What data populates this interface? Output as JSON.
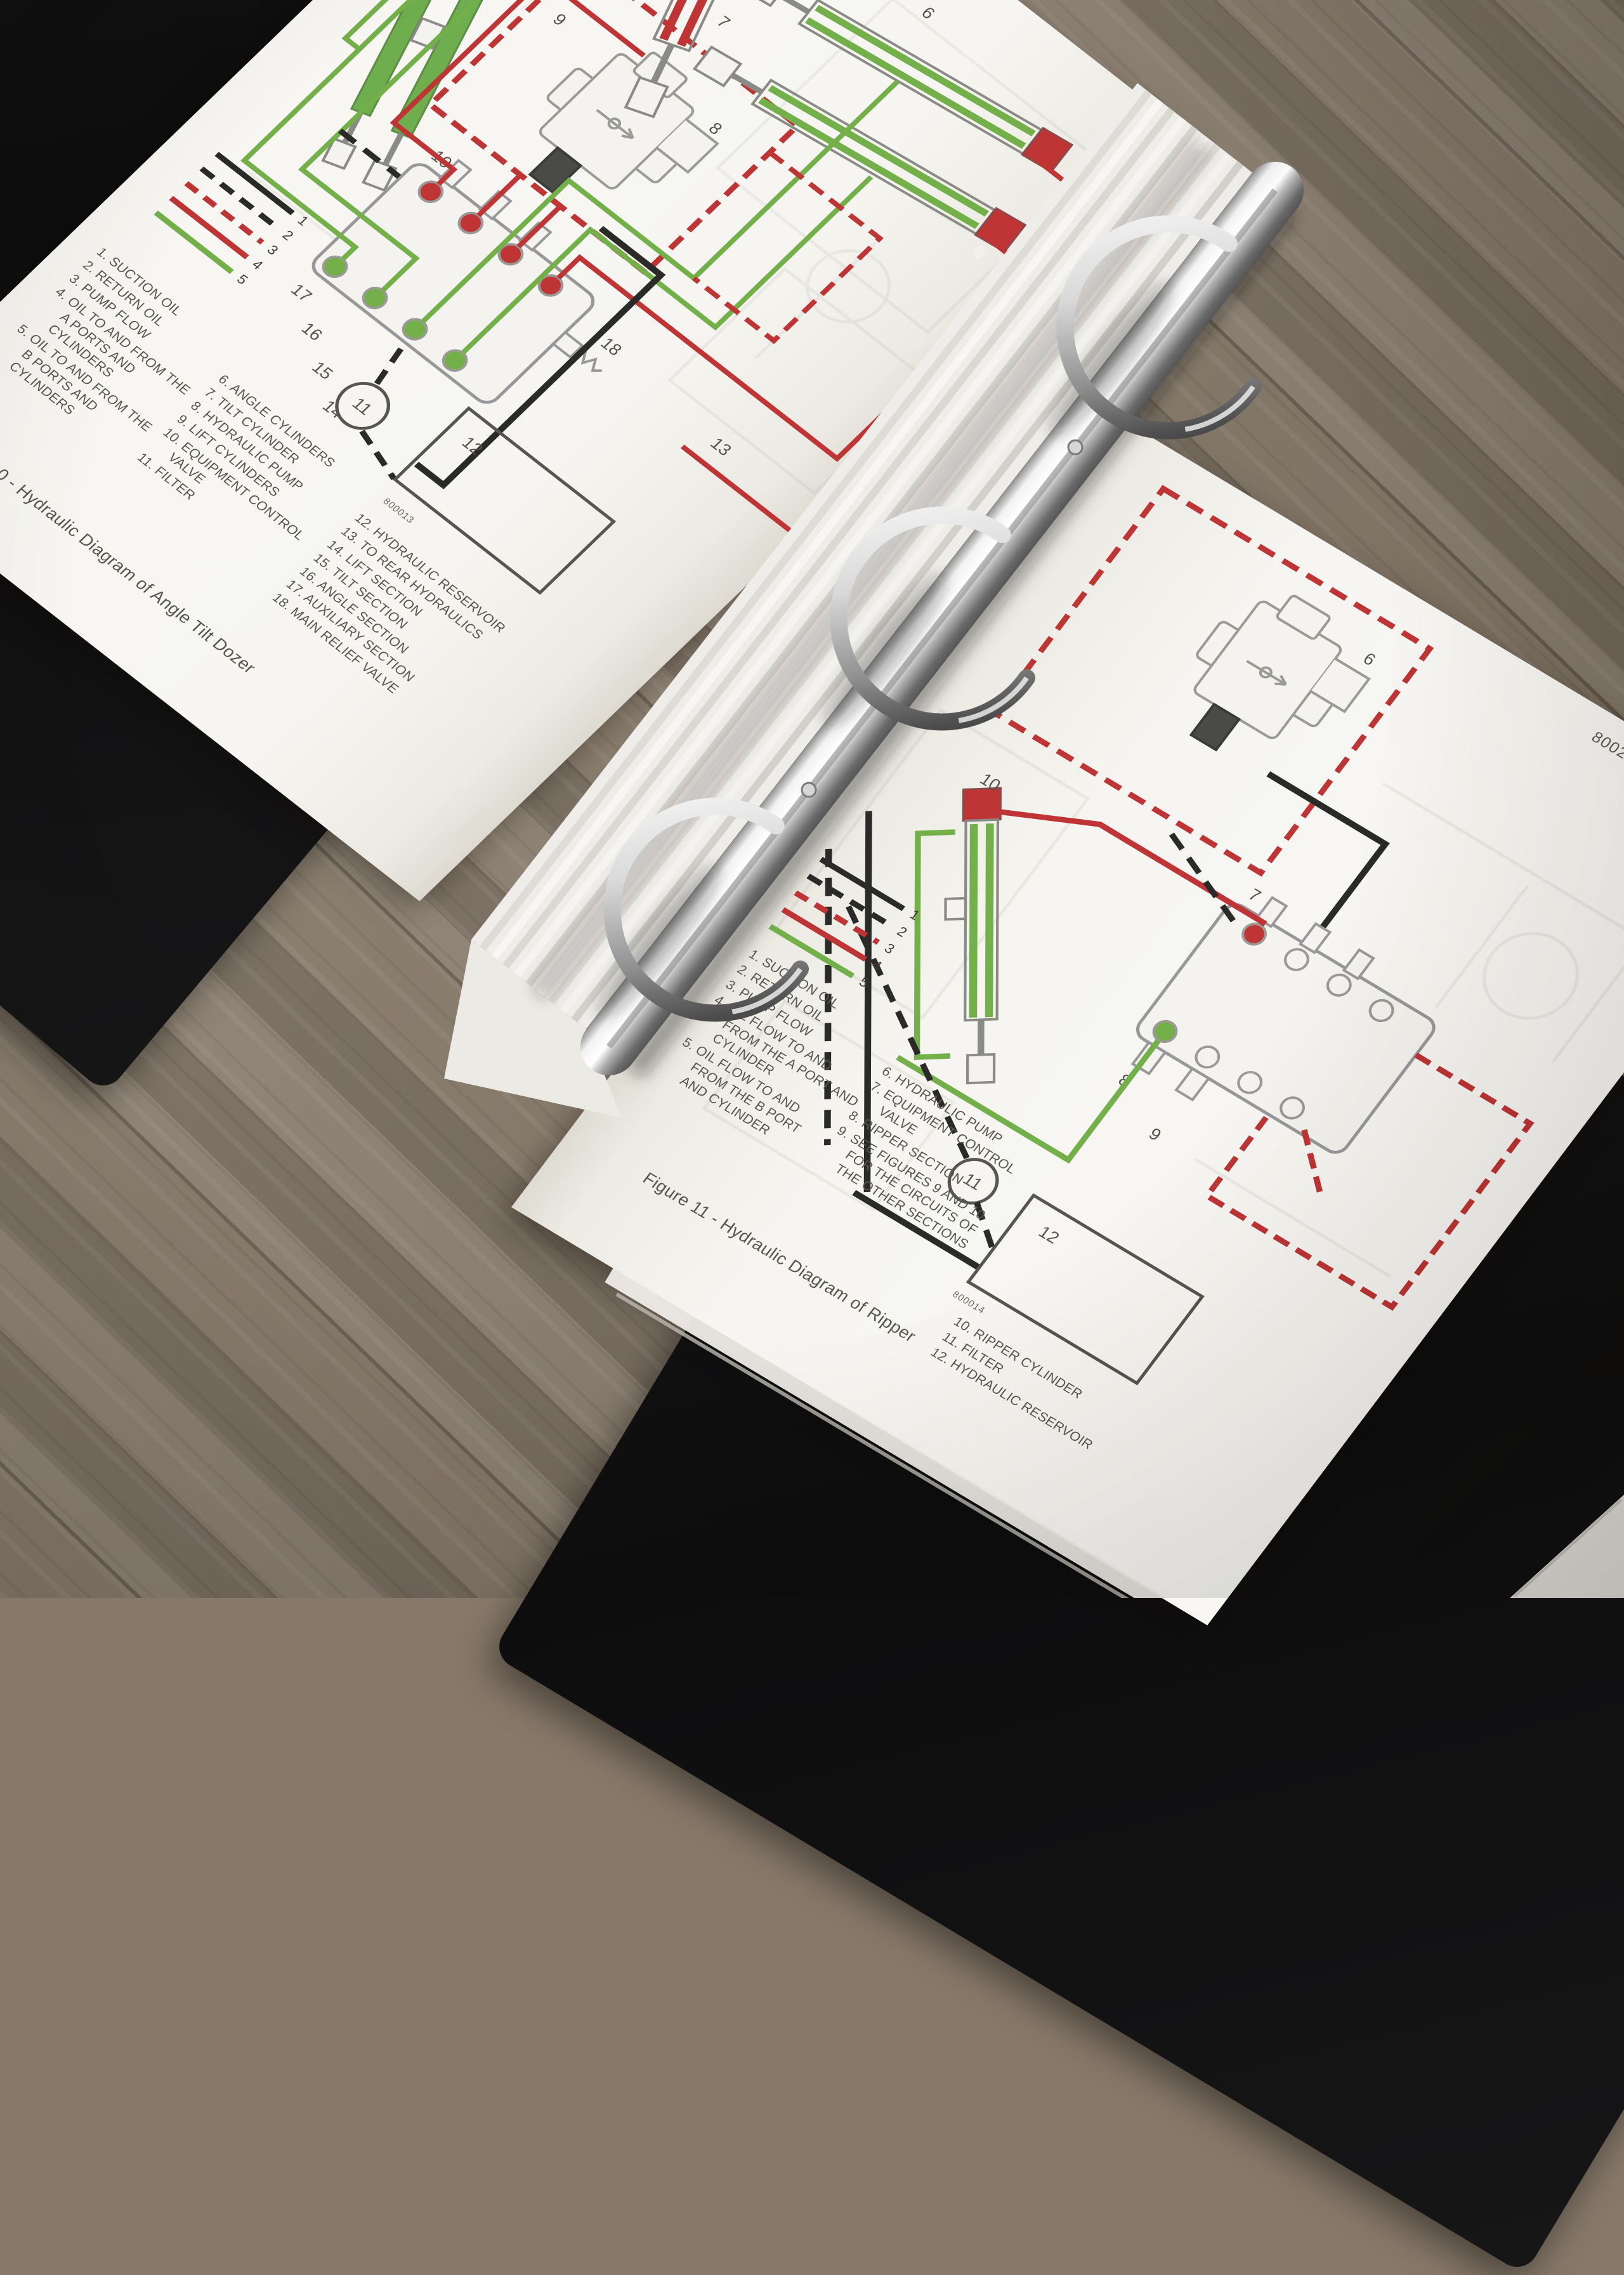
{
  "colors": {
    "paper": "#f6f5f1",
    "print_gray": "#56554e",
    "hydraulic_red": "#bf3434",
    "hydraulic_green": "#74b04a",
    "line_black": "#2a2a28",
    "wood_floor": "#8a7c6b",
    "binder_cover": "#111112",
    "chrome_ring": "#d9d9d9"
  },
  "left_page": {
    "page_number": "8002-12",
    "legend_numbers": [
      "1",
      "2",
      "3",
      "4",
      "5"
    ],
    "parts_col1": [
      "1. SUCTION OIL",
      "2. RETURN OIL",
      "3. PUMP FLOW",
      "4. OIL TO AND FROM THE A PORTS AND CYLINDERS",
      "5. OIL TO AND FROM THE B PORTS AND CYLINDERS"
    ],
    "parts_col2": [
      "6. ANGLE CYLINDERS",
      "7. TILT CYLINDER",
      "8. HYDRAULIC PUMP",
      "9. LIFT CYLINDERS",
      "10. EQUIPMENT CONTROL VALVE",
      "11. FILTER"
    ],
    "parts_col3": [
      "12. HYDRAULIC RESERVOIR",
      "13. TO REAR HYDRAULICS",
      "14. LIFT SECTION",
      "15. TILT SECTION",
      "16. ANGLE SECTION",
      "17. AUXILIARY SECTION",
      "18. MAIN RELIEF VALVE"
    ],
    "caption": "Figure 10 - Hydraulic Diagram of Angle Tilt Dozer",
    "figure_code": "800013",
    "labels": {
      "angle_cylinders": "6",
      "tilt_cylinder": "7",
      "pump": "8",
      "lift_cylinders": "9",
      "control_valve": "10",
      "filter": "11",
      "reservoir": "12",
      "to_rear": "13",
      "lift_section": "14",
      "tilt_section": "15",
      "angle_section": "16",
      "aux_section": "17",
      "relief": "18"
    }
  },
  "right_page": {
    "page_number": "8002-13",
    "legend_numbers": [
      "1",
      "2",
      "3",
      "4",
      "5"
    ],
    "parts_col1": [
      "1. SUCTION OIL",
      "2. RETURN OIL",
      "3. PUMP FLOW",
      "4. OIL FLOW TO AND FROM THE A PORT AND CYLINDER",
      "5. OIL FLOW TO AND FROM THE B PORT AND CYLINDER"
    ],
    "parts_col2": [
      "6. HYDRAULIC PUMP",
      "7. EQUIPMENT CONTROL VALVE",
      "8. RIPPER SECTION",
      "9. SEE FIGURES 9 AND 10 FOR THE CIRCUITS OF THE OTHER SECTIONS"
    ],
    "parts_col3": [
      "10. RIPPER CYLINDER",
      "11. FILTER",
      "12. HYDRAULIC RESERVOIR"
    ],
    "caption": "Figure 11 - Hydraulic Diagram of Ripper",
    "figure_code": "800014",
    "labels": {
      "pump": "6",
      "control_valve": "7",
      "ripper_section": "8",
      "see_note": "9",
      "ripper_cylinder": "10",
      "filter": "11",
      "reservoir": "12"
    }
  }
}
